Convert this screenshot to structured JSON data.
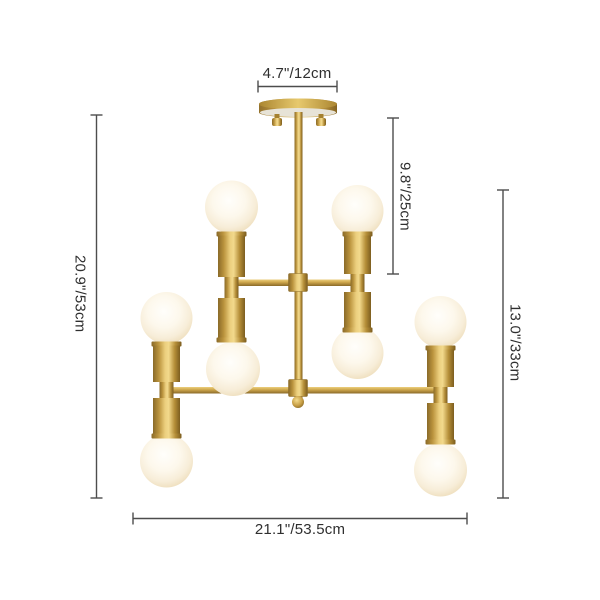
{
  "labels": {
    "canopy_width": "4.7\"/12cm",
    "stem_drop": "9.8\"/25cm",
    "total_height": "20.9\"/53cm",
    "body_height": "13.0\"/33cm",
    "total_width": "21.1\"/53.5cm"
  },
  "fixture": {
    "bulb_count": 8
  },
  "colors": {
    "background": "#ffffff",
    "gold_dark": "#7c5d1f",
    "gold_mid": "#c9a24a",
    "gold_highlight": "#f2d98c",
    "bulb_white": "#fdf8ec",
    "bulb_edge": "#f0e1c2",
    "dimension_line": "#4d4d4d",
    "label_text": "#2f2f2f"
  }
}
